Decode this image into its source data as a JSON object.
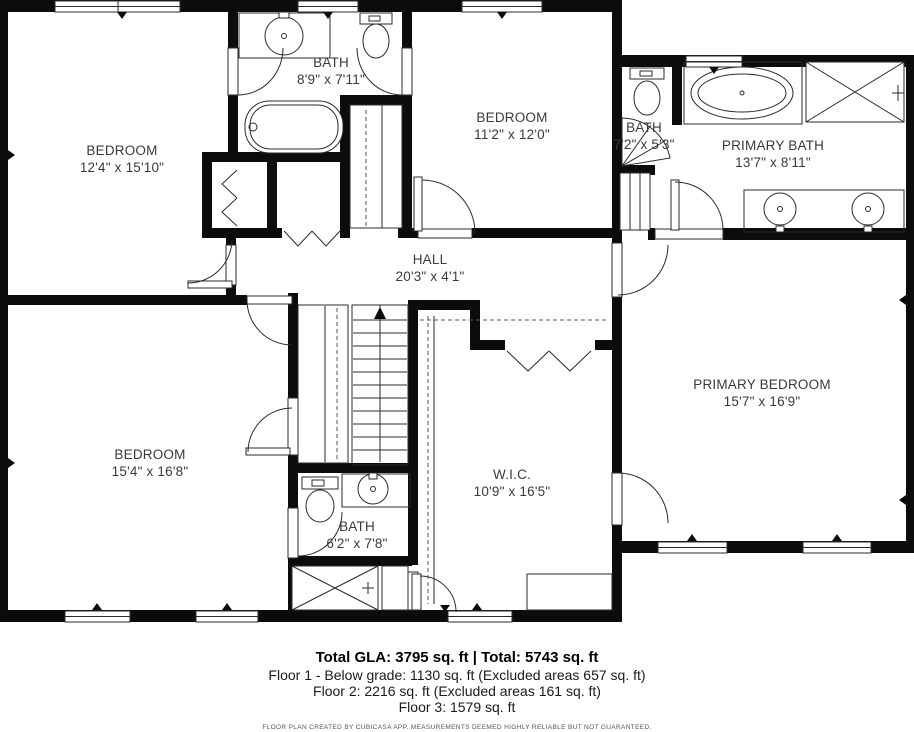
{
  "rooms": [
    {
      "id": "bedroom-top-left",
      "name": "BEDROOM",
      "dims": "12'4\" x 15'10\""
    },
    {
      "id": "bath-top",
      "name": "BATH",
      "dims": "8'9\" x 7'11\""
    },
    {
      "id": "bedroom-top-middle",
      "name": "BEDROOM",
      "dims": "11'2\" x 12'0\""
    },
    {
      "id": "bath-small",
      "name": "BATH",
      "dims": "7'2\" x 5'3\""
    },
    {
      "id": "primary-bath",
      "name": "PRIMARY BATH",
      "dims": "13'7\" x 8'11\""
    },
    {
      "id": "hall",
      "name": "HALL",
      "dims": "20'3\" x 4'1\""
    },
    {
      "id": "bedroom-bottom-left",
      "name": "BEDROOM",
      "dims": "15'4\" x 16'8\""
    },
    {
      "id": "walk-in-closet",
      "name": "W.I.C.",
      "dims": "10'9\" x 16'5\""
    },
    {
      "id": "primary-bedroom",
      "name": "PRIMARY BEDROOM",
      "dims": "15'7\" x 16'9\""
    },
    {
      "id": "bath-bottom",
      "name": "BATH",
      "dims": "6'2\" x 7'8\""
    }
  ],
  "footer": {
    "total_line": "Total GLA: 3795 sq. ft | Total: 5743 sq. ft",
    "floor1_line": "Floor 1 - Below grade: 1130 sq. ft (Excluded areas 657 sq. ft)",
    "floor2_line": "Floor 2: 2216 sq. ft (Excluded areas 161 sq. ft)",
    "floor3_line": "Floor 3: 1579 sq. ft",
    "disclaimer": "FLOOR PLAN CREATED BY CUBICASA APP. MEASUREMENTS DEEMED HIGHLY RELIABLE BUT NOT GUARANTEED."
  },
  "fixtures": [
    "toilet",
    "sink",
    "bathtub",
    "oval-tub",
    "shower",
    "stairs",
    "door",
    "bifold-door",
    "window",
    "closet-rail",
    "vanity"
  ],
  "colors": {
    "wall": "#0c0c0c",
    "line": "#2b2b2b",
    "label": "#3a3a3a",
    "background": "#ffffff"
  }
}
